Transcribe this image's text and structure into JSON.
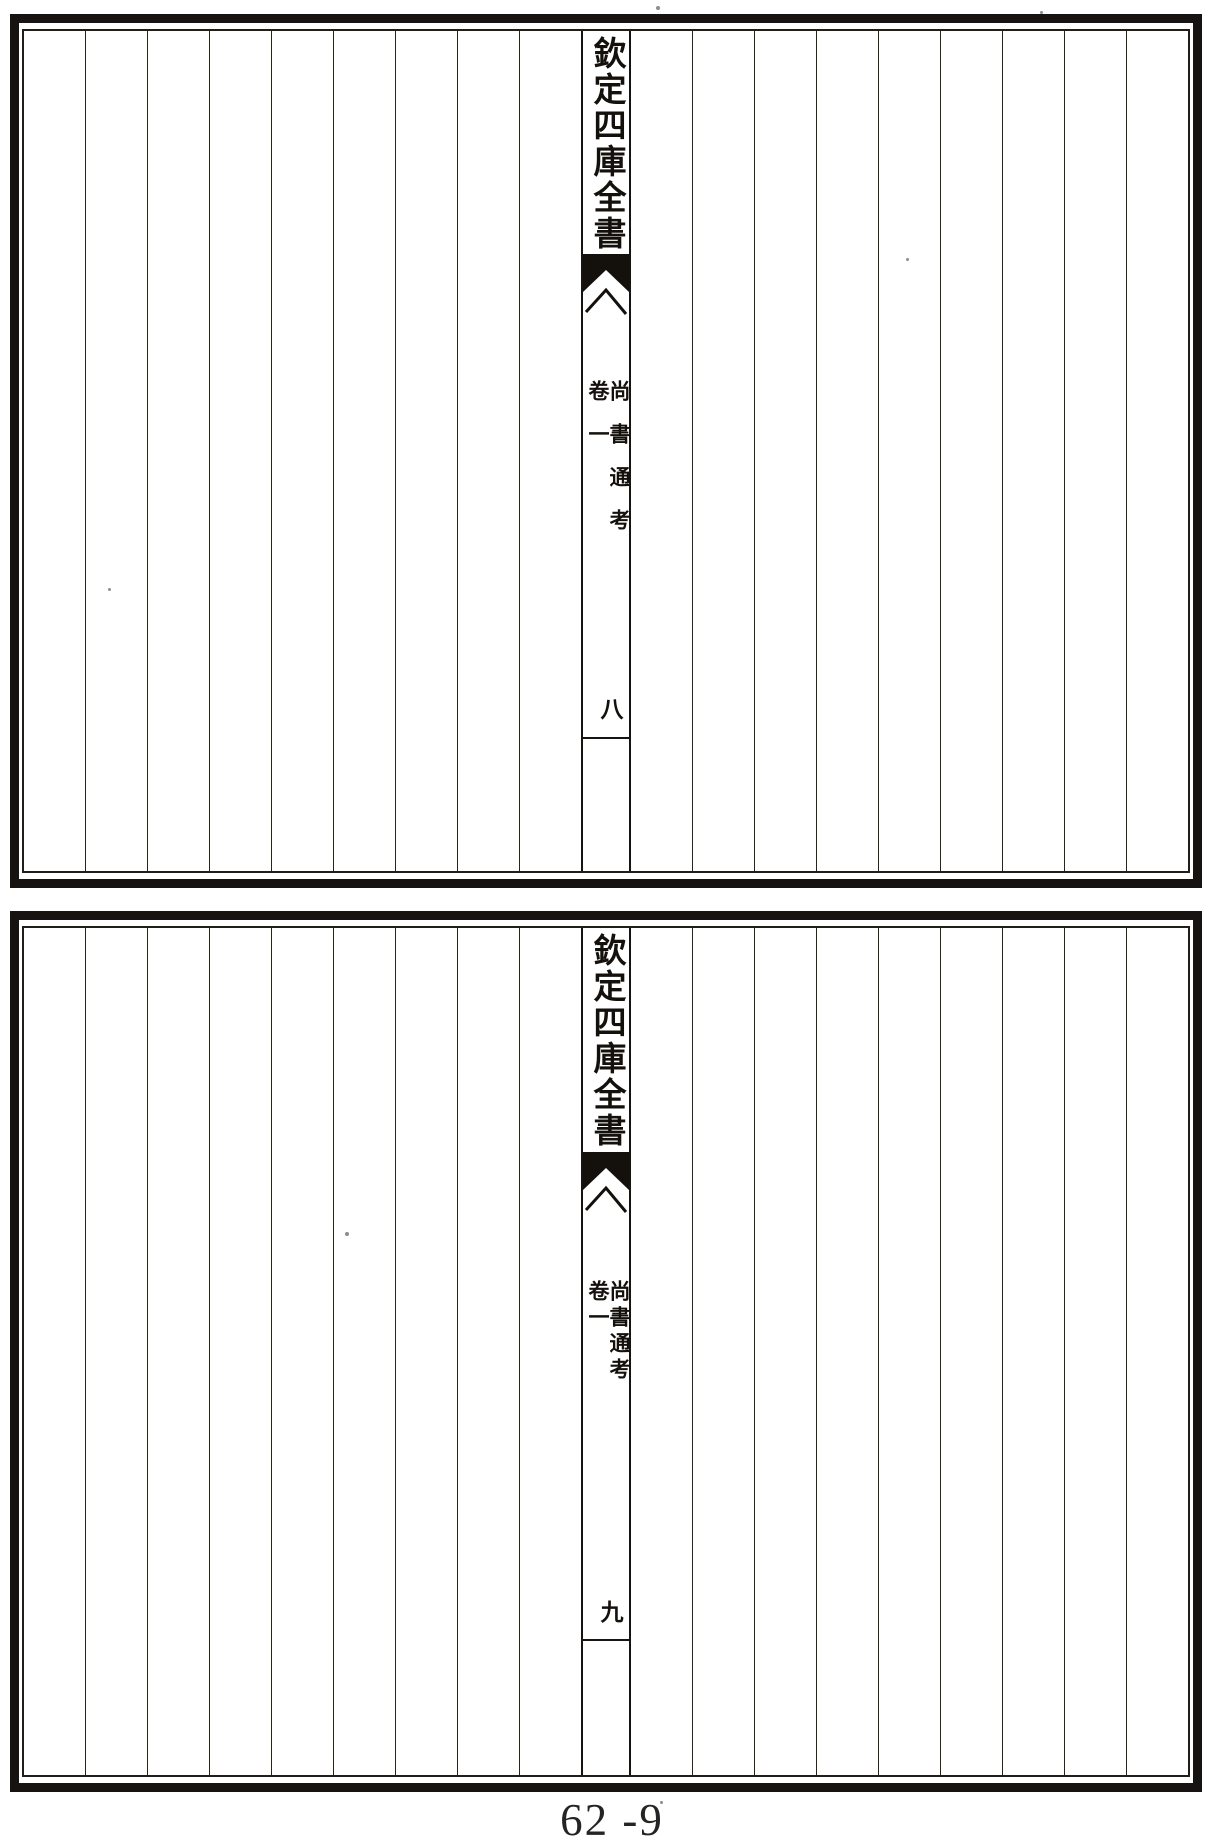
{
  "colors": {
    "ink": "#14110d",
    "paper": "#ffffff"
  },
  "pages": [
    {
      "id": "top",
      "banxin": {
        "imprint_title": "欽定四庫全書",
        "book_title": "尚書通考",
        "volume_label": "卷一",
        "page_number": "八"
      }
    },
    {
      "id": "bottom",
      "banxin": {
        "imprint_title": "欽定四庫全書",
        "book_title": "尚書通考",
        "volume_label": "卷一",
        "page_number": "九"
      }
    }
  ],
  "footer": {
    "folio_label": "62 -9"
  }
}
